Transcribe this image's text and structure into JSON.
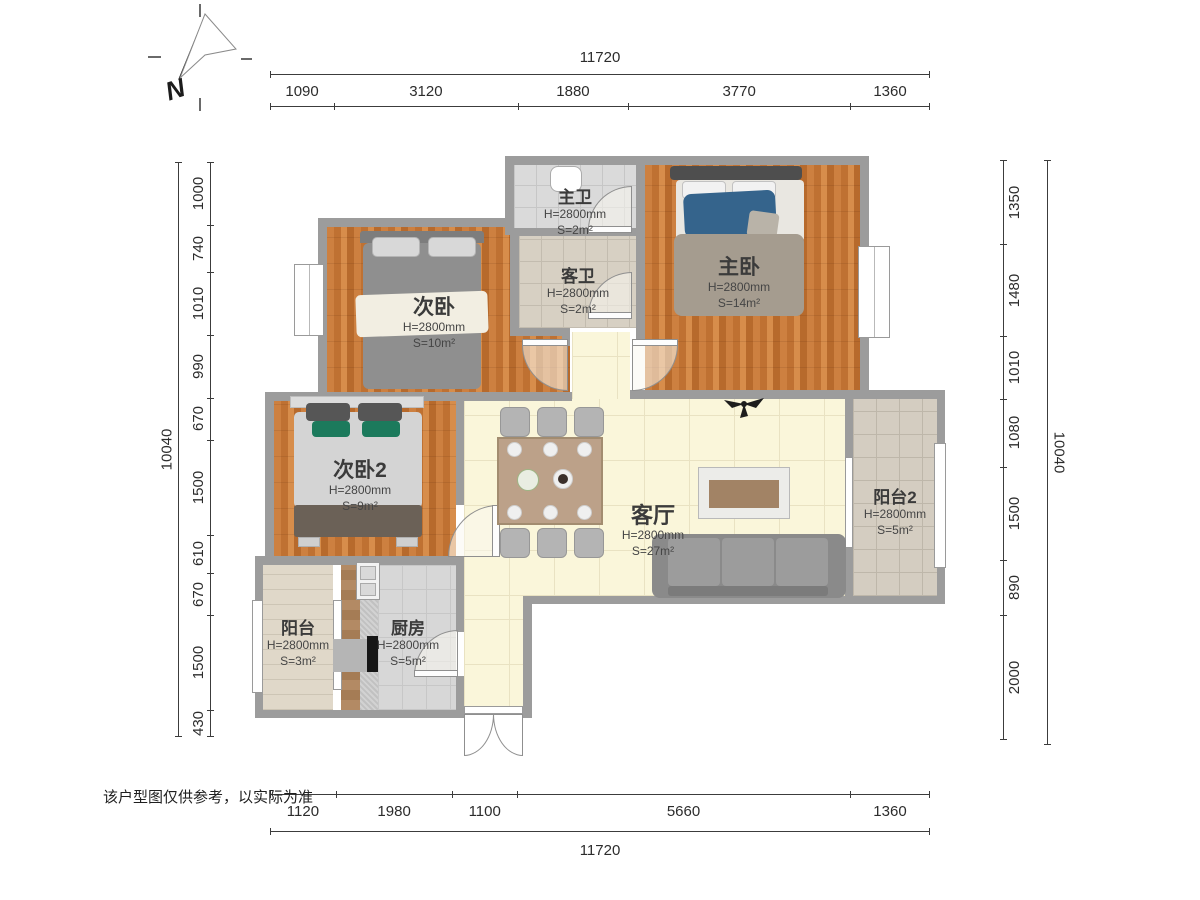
{
  "compass": {
    "label": "N"
  },
  "disclaimer": "该户型图仅供参考，以实际为准",
  "dimensions": {
    "top": {
      "total": "11720",
      "segments": [
        "1090",
        "3120",
        "1880",
        "3770",
        "1360"
      ]
    },
    "bottom": {
      "total": "11720",
      "segments": [
        "1120",
        "1980",
        "1100",
        "5660",
        "1360"
      ]
    },
    "left": {
      "total": "10040",
      "segments": [
        "1000",
        "740",
        "1010",
        "990",
        "670",
        "1500",
        "610",
        "670",
        "1500",
        "430"
      ]
    },
    "right": {
      "total": "10040",
      "segments": [
        "1350",
        "1480",
        "1010",
        "1080",
        "1500",
        "890",
        "2000"
      ]
    }
  },
  "rooms": [
    {
      "name": "主卫",
      "height": "H=2800mm",
      "area": "S=2m²"
    },
    {
      "name": "客卫",
      "height": "H=2800mm",
      "area": "S=2m²"
    },
    {
      "name": "次卧",
      "height": "H=2800mm",
      "area": "S=10m²"
    },
    {
      "name": "主卧",
      "height": "H=2800mm",
      "area": "S=14m²"
    },
    {
      "name": "次卧2",
      "height": "H=2800mm",
      "area": "S=9m²"
    },
    {
      "name": "客厅",
      "height": "H=2800mm",
      "area": "S=27m²"
    },
    {
      "name": "阳台2",
      "height": "H=2800mm",
      "area": "S=5m²"
    },
    {
      "name": "阳台",
      "height": "H=2800mm",
      "area": "S=3m²"
    },
    {
      "name": "厨房",
      "height": "H=2800mm",
      "area": "S=5m²"
    }
  ],
  "colors": {
    "wall": "#9c9c9c",
    "wood_floor": "#c67b36",
    "living_floor": "#faf6da",
    "bed_blue": "#35648c",
    "cushion_green": "#1c7a5c"
  }
}
